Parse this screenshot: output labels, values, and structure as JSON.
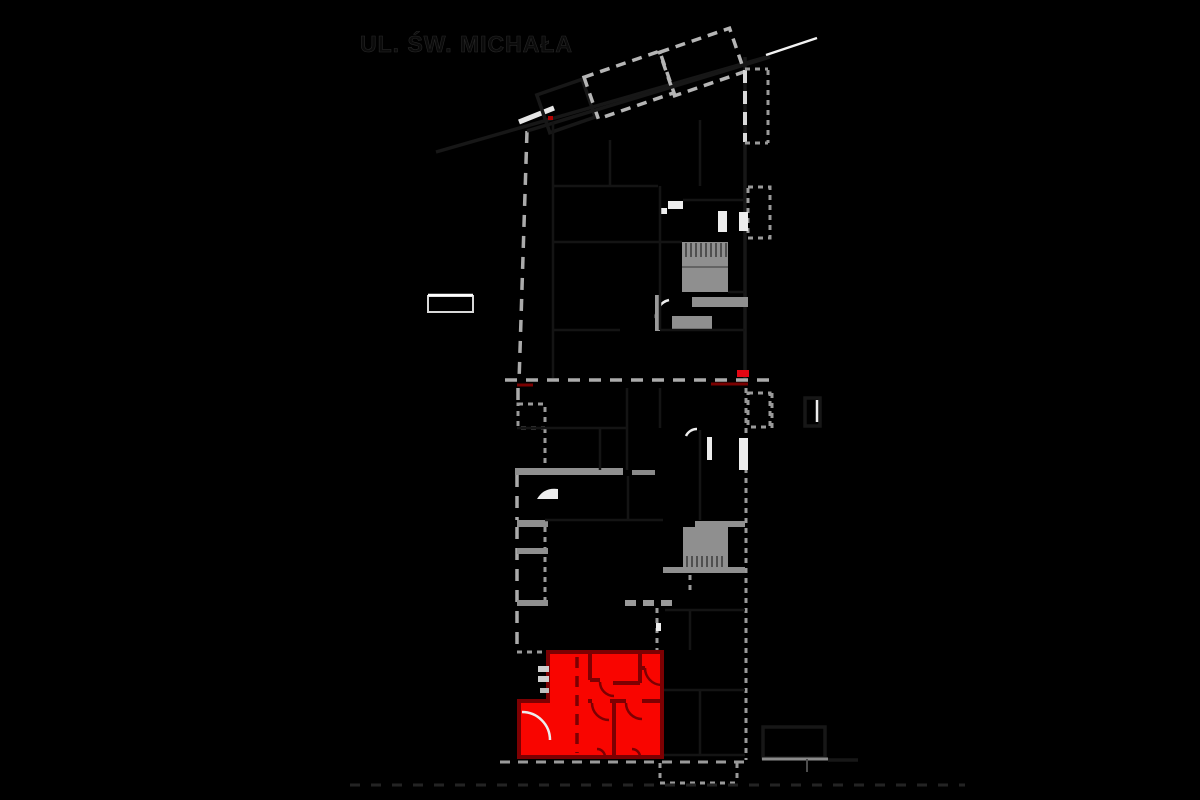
{
  "street": {
    "name": "UL. ŚW. MICHAŁA"
  },
  "unit": {
    "highlight_fill": "#f90500",
    "wall_color": "#7d0002"
  },
  "markers": {
    "entrance_red": "#e30613",
    "small_red_dot": "#b00000"
  },
  "canvas": {
    "background": "#000000",
    "boundary_gray": "#ababab",
    "structure_gray": "#8f8f8f",
    "accent_white": "#ededed"
  }
}
